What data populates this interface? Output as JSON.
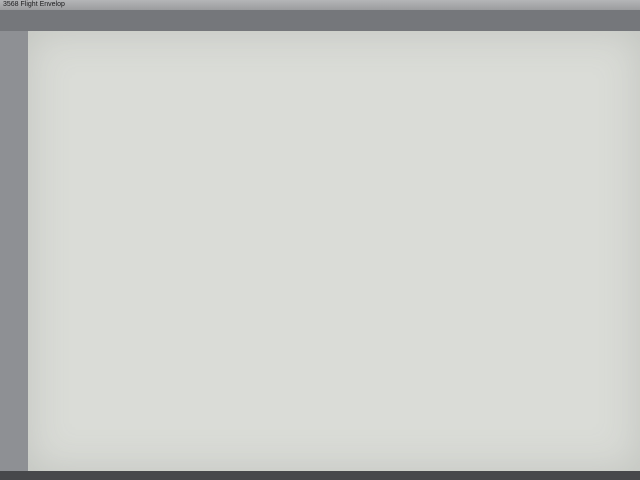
{
  "window": {
    "title": "3568 Flight Envelop"
  },
  "raise_lower": {
    "title": "BOOM RAISE/LOWER",
    "y_ticks": [
      "9m",
      "8",
      "7",
      "6",
      "5",
      "4",
      "3",
      "2",
      "1"
    ],
    "x_ticks": [
      "-2",
      "-1",
      "0",
      "1",
      "2",
      "3",
      "4",
      "5",
      "6m"
    ]
  },
  "slew": {
    "title": "BOOM SLEW",
    "cab": "CAB",
    "top_left_angle": "30°",
    "top_right_angle": "30°",
    "bottom_left_angle": "60°",
    "bottom_right_angle": "60°"
  },
  "legend": {
    "full": {
      "l1": "FULL FLIGHT",
      "l2": "(MAX. REACH 5.81M",
      "l3": "FROM TURRET)"
    },
    "restricted": {
      "l1": "RESTRICTED FLIGHT",
      "l2": "(MAX. REACH 3.93M",
      "l3": "FROM TURRET)"
    }
  },
  "limits_table": {
    "title": "BOOM RAISE/LOWER LIMITS",
    "row1_label_l1": "Maximum boom angle",
    "row1_label_l2": "from horizontal",
    "row1_value": "60°",
    "row2_label_l1": "Minimum boom angle",
    "row2_label_l2": "from horizontal",
    "row2_value": "-25°"
  },
  "company": {
    "name1": "R.K.FINDLAY",
    "name2": "CONSULTING ENGINEERS",
    "addr1": "5/17 Pembury Rd",
    "addr2": "MINTO NSW 2566",
    "phone": "Ph. (02) 9824 5140 Fax. (02) 9824 5142"
  },
  "titleblock": {
    "rev": "A",
    "rev_date": "26/9/16",
    "rev_by": "PHZ",
    "rev_details": "ORIGINAL ISSUE",
    "h_rev": "REV",
    "h_date": "DATE",
    "h_by": "BY",
    "h_details": "DETAILS",
    "desc1": "Sheridan NL90DT on ISUZU NPS 300",
    "desc2": "with PESSL Hi-Rail (Registration S3556B)",
    "desc3": "Flight Envelop",
    "chd": "Chd.",
    "drawn": "Drawn PHZ",
    "date": "Date 26/9/16",
    "scale": "Scale NTS",
    "drg_label": "Drg. No.",
    "drg_no": "S60928-01",
    "edition_label": "Edition",
    "edition": "A",
    "sheet_label": "Sheet",
    "sheet": "1/1"
  },
  "colors": {
    "full_flight_green": "#69a769",
    "restricted_red": "#cf9184",
    "grid_blue": "#8d8fc8",
    "cab_yellow": "#e5de3f",
    "annotation_blue": "#2f45c0"
  }
}
